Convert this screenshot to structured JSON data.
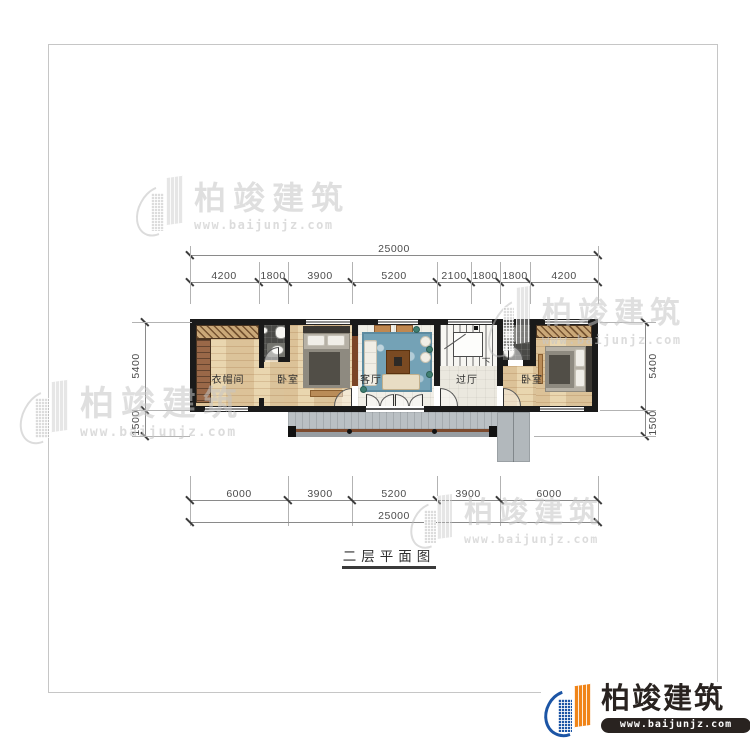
{
  "drawing": {
    "title": "二层平面图",
    "stairs_down_label": "下"
  },
  "rooms": {
    "cloakroom": "衣帽间",
    "bedroom_left": "卧室",
    "living_room": "客厅",
    "hallway": "过厅",
    "bedroom_right": "卧室"
  },
  "dims": {
    "top": {
      "total": "25000",
      "segments": [
        "4200",
        "1800",
        "3900",
        "5200",
        "2100",
        "1800",
        "1800",
        "4200"
      ]
    },
    "bottom": {
      "total": "25000",
      "segments": [
        "6000",
        "3900",
        "5200",
        "3900",
        "6000"
      ]
    },
    "left": {
      "segments": [
        "5400",
        "1500"
      ]
    },
    "right": {
      "segments": [
        "5400",
        "1500"
      ]
    }
  },
  "brand": {
    "name": "柏竣建筑",
    "url": "www.baijunjz.com",
    "colors": {
      "blue": "#1c55a5",
      "orange": "#f08418",
      "dark": "#292320",
      "watermark": "#c4c4c4"
    }
  },
  "palette": {
    "wall": "#1a1a1a",
    "wood": "#e6d3ac",
    "tile": "#f1efe7",
    "bath": "#4a4a47",
    "balcony": "#bac0c4",
    "rug": "#74a2b6"
  }
}
